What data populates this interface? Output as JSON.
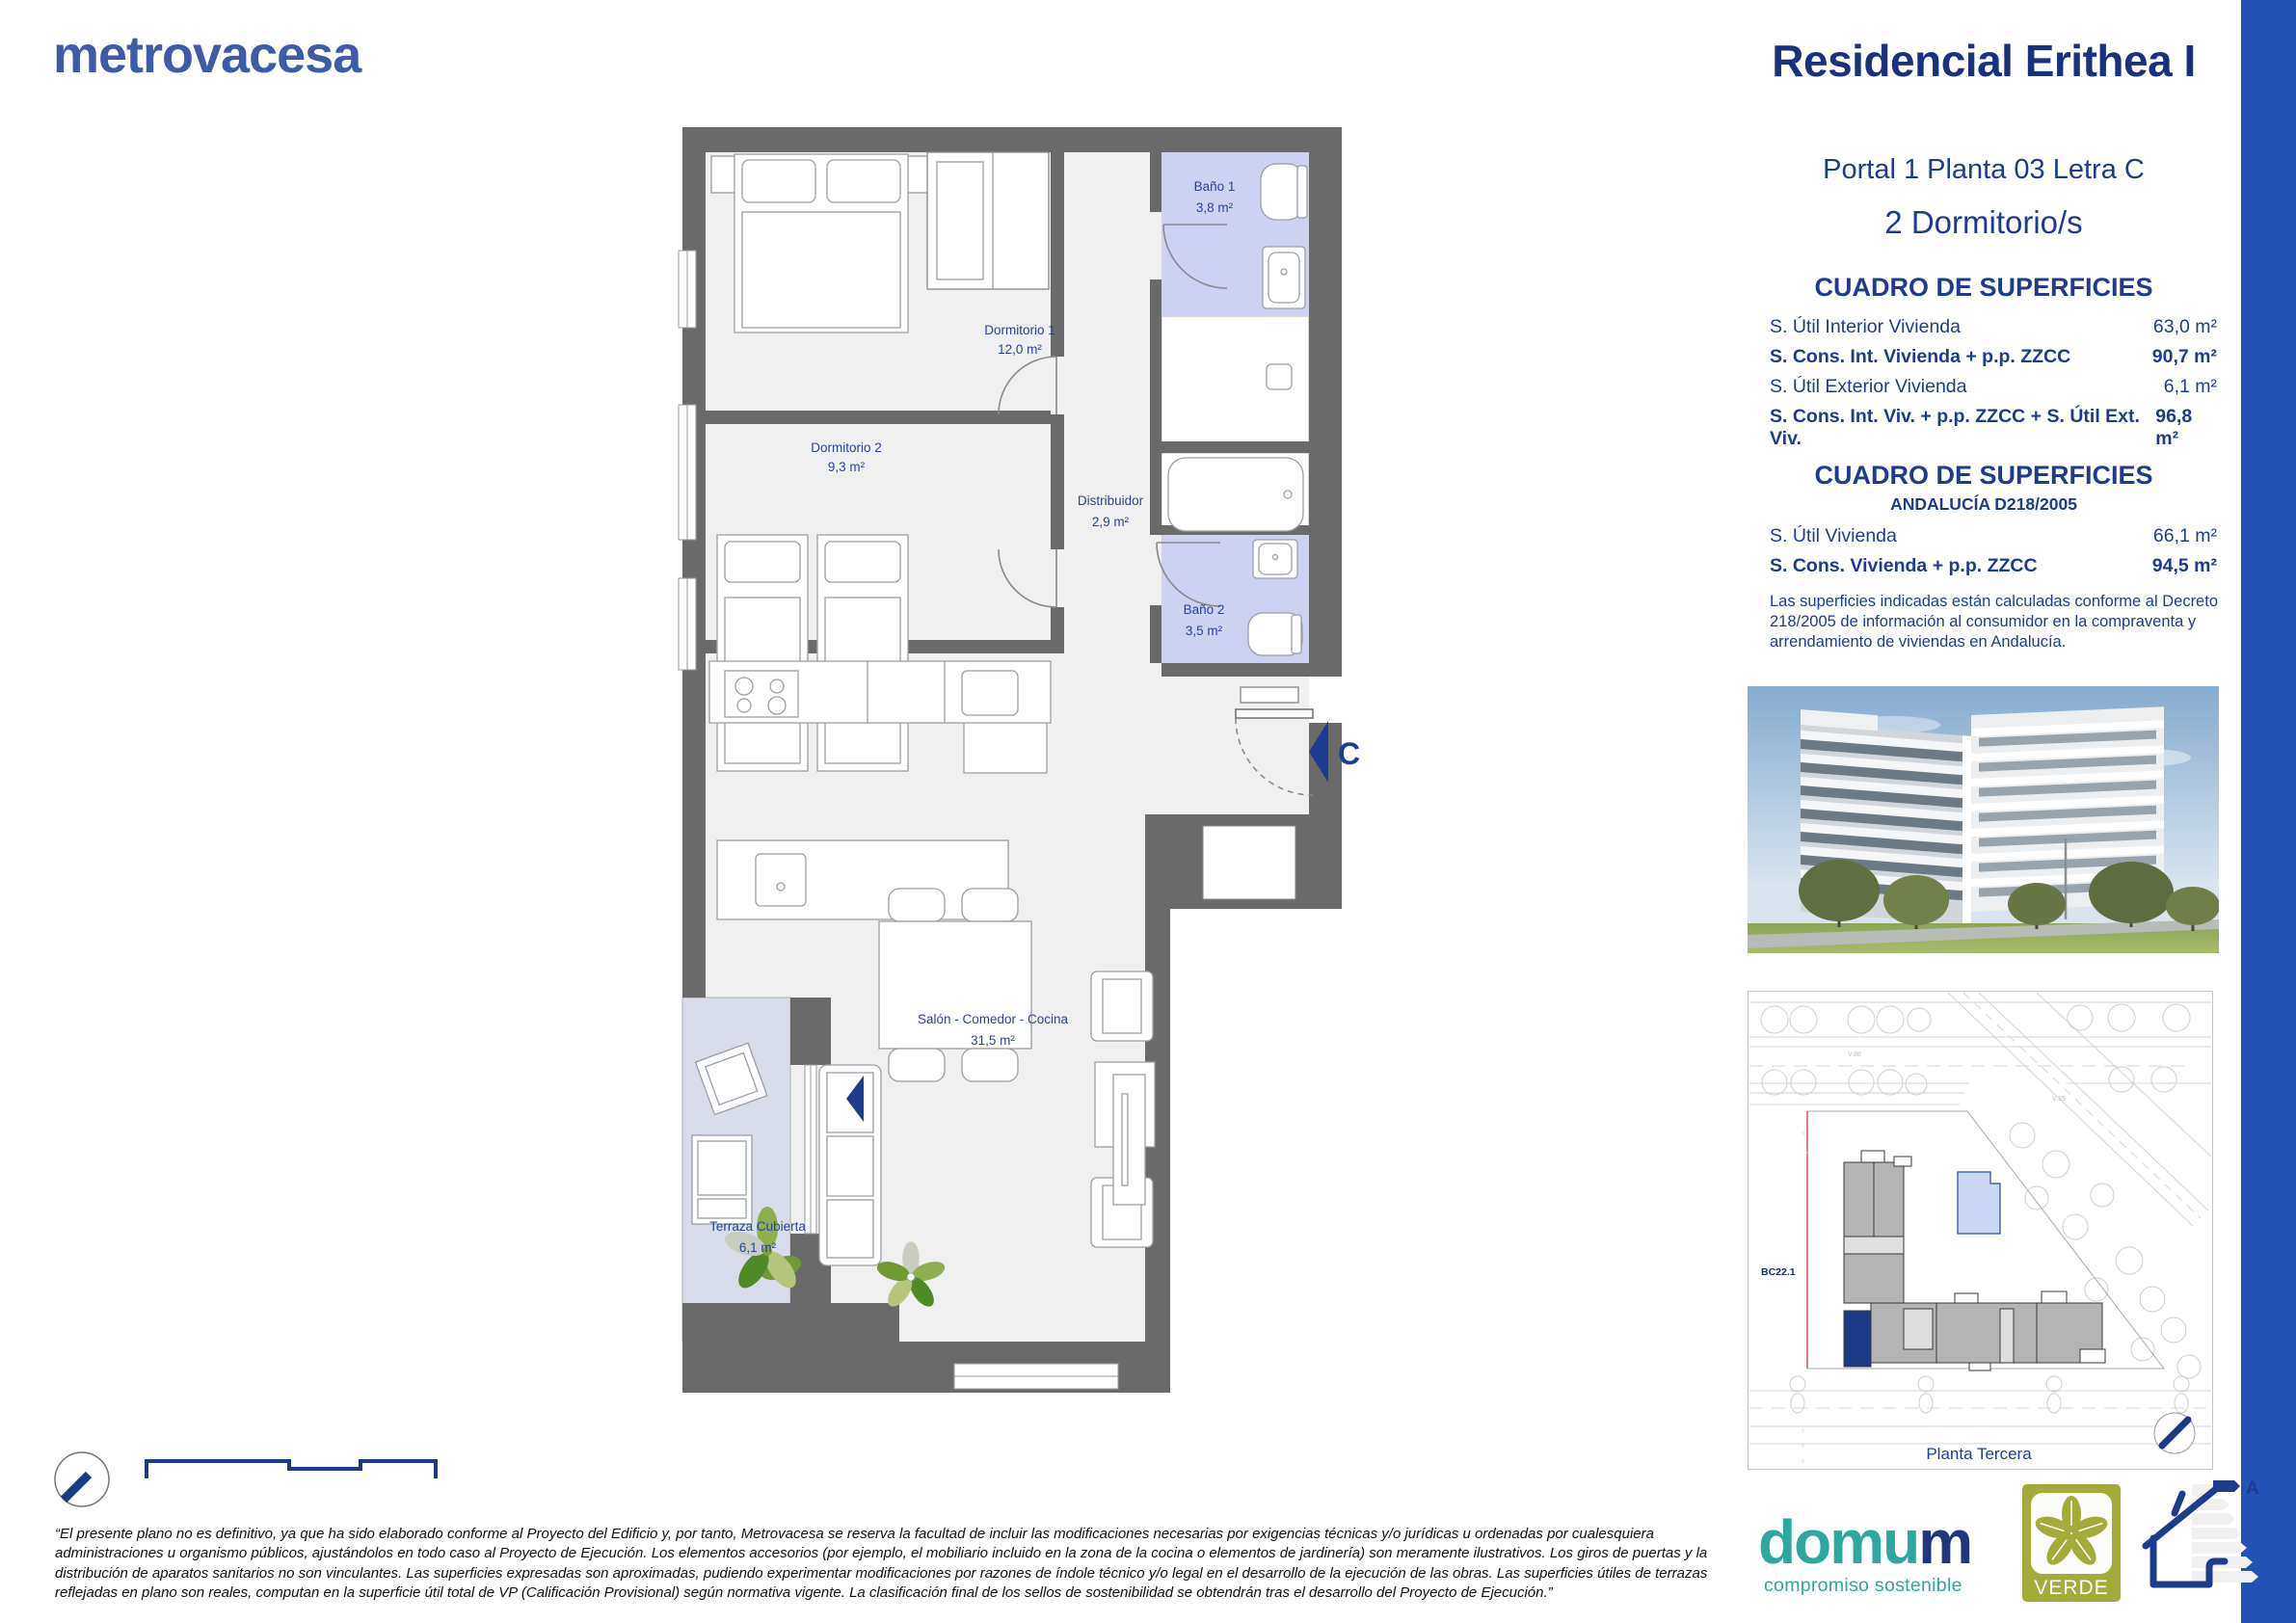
{
  "brand": {
    "name": "metrovacesa"
  },
  "header": {
    "title": "Residencial Erithea I",
    "location": "Portal 1 Planta 03 Letra C",
    "bedrooms": "2 Dormitorio/s"
  },
  "surfaces": {
    "title": "CUADRO DE SUPERFICIES",
    "rows": [
      {
        "label": "S. Útil Interior Vivienda",
        "value": "63,0 m²"
      },
      {
        "label": "S. Cons. Int. Vivienda + p.p. ZZCC",
        "value": "90,7 m²"
      },
      {
        "label": "S. Útil Exterior Vivienda",
        "value": "6,1 m²"
      },
      {
        "label": "S. Cons. Int. Viv. + p.p. ZZCC + S. Útil Ext. Viv.",
        "value": "96,8 m²"
      }
    ]
  },
  "surfaces_andalucia": {
    "title": "CUADRO DE SUPERFICIES",
    "subtitle": "ANDALUCÍA D218/2005",
    "rows": [
      {
        "label": "S. Útil Vivienda",
        "value": "66,1 m²"
      },
      {
        "label": "S. Cons. Vivienda + p.p. ZZCC",
        "value": "94,5 m²"
      }
    ],
    "note": "Las superficies indicadas están calculadas conforme al Decreto 218/2005 de información al consumidor en la compraventa y arrendamiento de viviendas en Andalucía."
  },
  "floorplan": {
    "rooms": [
      {
        "name": "Dormitorio 1",
        "area": "12,0 m²"
      },
      {
        "name": "Dormitorio 2",
        "area": "9,3 m²"
      },
      {
        "name": "Baño 1",
        "area": "3,8 m²"
      },
      {
        "name": "Baño 2",
        "area": "3,5 m²"
      },
      {
        "name": "Distribuidor",
        "area": "2,9 m²"
      },
      {
        "name": "Salón - Comedor - Cocina",
        "area": "31,5 m²"
      },
      {
        "name": "Terraza Cubierta",
        "area": "6,1 m²"
      }
    ],
    "entrance_label": "C"
  },
  "siteplan": {
    "parcel_label": "BC22.1",
    "road_labels": [
      "V.88",
      "V.15"
    ],
    "caption": "Planta Tercera"
  },
  "footer": {
    "disclaimer": "“El presente plano no es definitivo, ya que ha sido elaborado conforme al Proyecto del Edificio y, por tanto, Metrovacesa se reserva la facultad de incluir las modificaciones necesarias por exigencias técnicas y/o jurídicas u ordenadas por cualesquiera administraciones u organismo públicos, ajustándolos en todo caso al Proyecto de Ejecución. Los elementos accesorios (por ejemplo, el mobiliario incluido en la zona de la cocina o elementos de jardinería) son meramente ilustrativos. Los giros de puertas y la distribución de aparatos sanitarios no son vinculantes. Las superficies expresadas son aproximadas, pudiendo experimentar modificaciones por razones de índole técnico y/o legal en el desarrollo de la ejecución de las obras. Las superficies útiles de terrazas reflejadas en plano son reales, computan en la superficie útil total de VP (Calificación Provisional) según normativa vigente. La clasificación final de los sellos de sostenibilidad se obtendrán tras el desarrollo del Proyecto de Ejecución.”",
    "domum": {
      "word_teal": "domu",
      "word_navy": "m",
      "tagline": "compromiso sostenible"
    },
    "verde_label": "VERDE",
    "energy_label": "A"
  },
  "colors": {
    "navy": "#1e3c8e",
    "title_navy": "#1a3180",
    "brand_blue": "#3d5ba9",
    "side_bar": "#2352b5",
    "wall_gray": "#6a6a6a",
    "bath_lavender": "#cdd1f2",
    "terrace_blue_gray": "#d9dcea",
    "floor_gray": "#f0f0f1",
    "teal": "#2ea79e",
    "olive": "#a5ab3a"
  }
}
